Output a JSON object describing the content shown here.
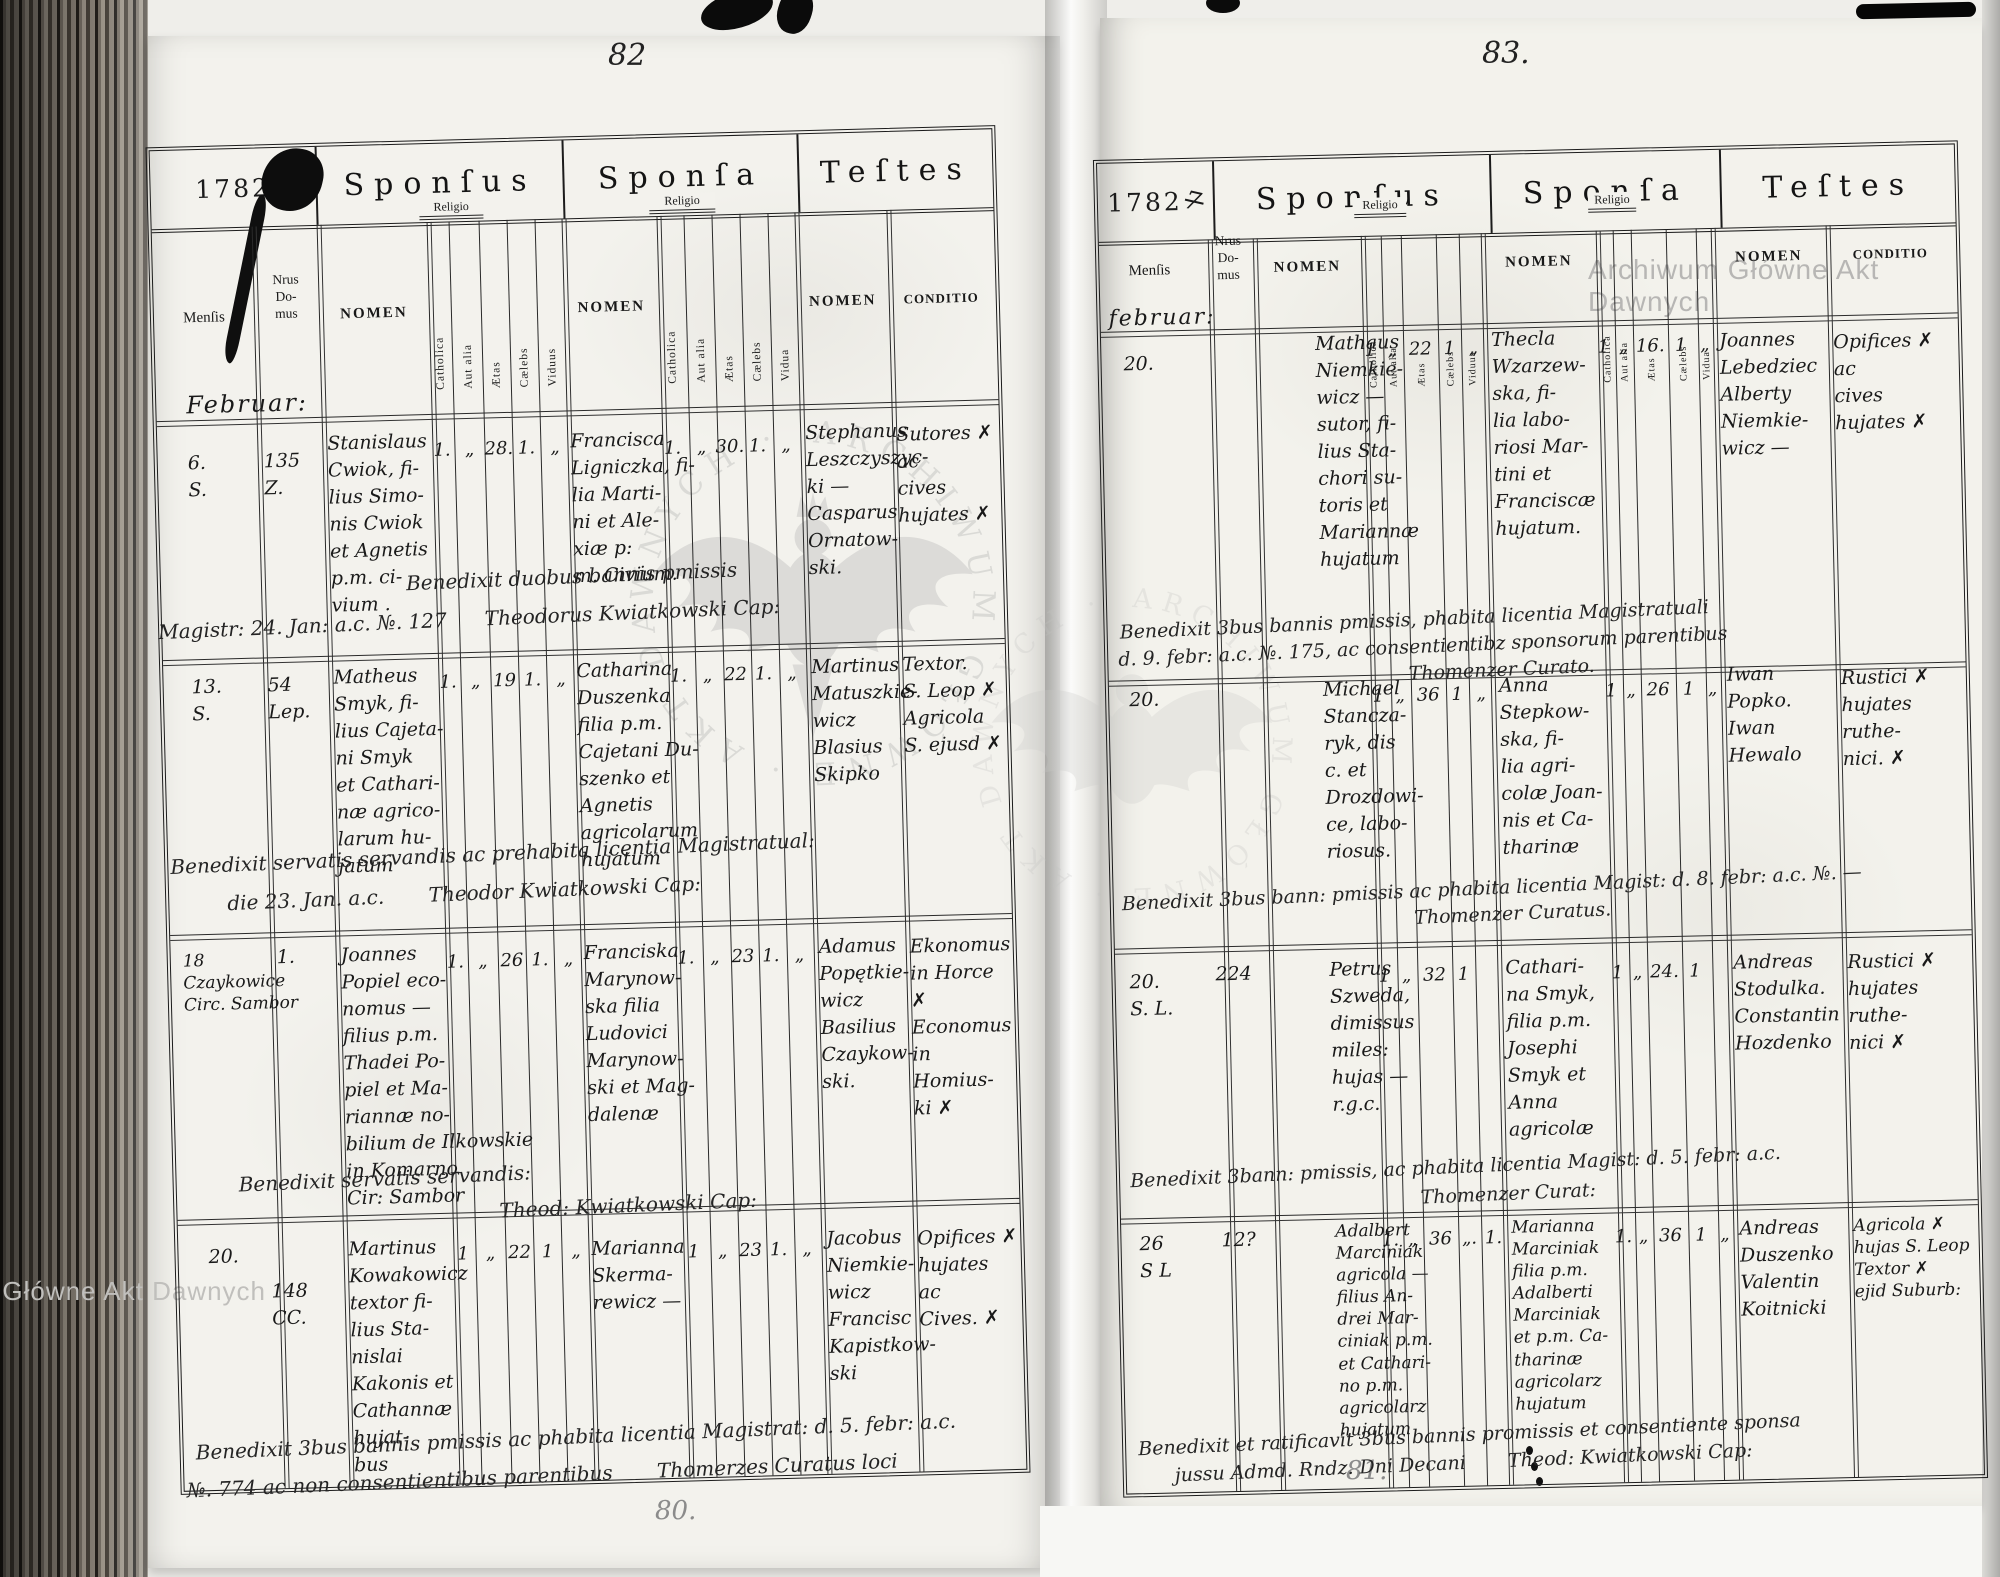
{
  "watermark": {
    "corner_text": "Archiwum Główne Akt Dawnych",
    "circular_text": "ARCHIWUM GŁÓWNE · AKT DAWNYCH ·"
  },
  "sections": {
    "sponsus": "Sponſus",
    "sponsa": "Sponſa",
    "testes": "Teſtes"
  },
  "columns": {
    "mensis": "Menſis",
    "nrus": "Nrus\nDo-\nmus",
    "nomen": "NOMEN",
    "religio": "Religio",
    "catholica": "Catholica",
    "aut_alia": "Aut alia",
    "aetas": "Ætas",
    "caelebs": "Cælebs",
    "viduus": "Viduus",
    "vidua": "Vidua",
    "conditio": "CONDITIO"
  },
  "pages": {
    "left": {
      "page_number": "82",
      "pencil_number": "80.",
      "year": "1782",
      "month_heading": "Februar:",
      "entries": [
        {
          "mensis": "6.\nS.",
          "house": "135\nZ.",
          "sponsus_name": "Stanislaus\nCwiok, fi-\nlius Simo-\nnis Cwiok\net Agnetis\np.m. ci-\nvium .",
          "sponsus_marks": [
            "1.",
            "„",
            "28.",
            "1.",
            "„"
          ],
          "sponsa_name": "Francisca\nLigniczka, fi-\nlia Marti-\nni et Ale-\nxiæ p:\nm. Civium.",
          "sponsa_marks": [
            "1.",
            "„",
            "30.",
            "1.",
            "„"
          ],
          "witnesses": "Stephanus\nLeszczyszyc-\nki —\nCasparus\nOrnatow-\nski.",
          "conditio": "Sutores ✗\nac\ncives\nhujates ✗",
          "note1": "Benedixit duobus bannis pmissis",
          "note2": "Magistr: 24. Jan: a.c. №. 127      Theodorus Kwiatkowski Cap:"
        },
        {
          "mensis": "13.\nS.",
          "house": "54\nLep.",
          "sponsus_name": "Matheus\nSmyk, fi-\nlius Cajeta-\nni Smyk\net Cathari-\nnæ agrico-\nlarum hu-\njatum",
          "sponsus_marks": [
            "1.",
            "„",
            "19",
            "1.",
            "„"
          ],
          "sponsa_name": "Catharina\nDuszenka\nfilia p.m.\nCajetani Du-\nszenko et\nAgnetis\nagricolarum\nhujatum",
          "sponsa_marks": [
            "1.",
            "„",
            "22",
            "1.",
            "„"
          ],
          "witnesses": "Martinus\nMatuszkie-\nwicz\nBlasius\nSkipko",
          "conditio": "Textor.\nS. Leop ✗\nAgricola\nS. ejusd ✗",
          "note1": "Benedixit servatis servandis ac prehabita licentia Magistratual:",
          "note2": "die 23. Jan. a.c.       Theodor Kwiatkowski Cap:"
        },
        {
          "mensis": "18\nCzaykowice\nCirc. Sambor",
          "house": "1.",
          "sponsus_name": "Joannes\nPopiel eco-\nnomus —\nfilius p.m.\nThadei Po-\npiel et Ma-\nriannæ no-\nbilium de Ilkowskie\nin Komarno\nCir: Sambor",
          "sponsus_marks": [
            "1.",
            "„",
            "26",
            "1.",
            "„"
          ],
          "sponsa_name": "Franciska\nMarynow-\nska filia\nLudovici\nMarynow-\nski et Mag-\ndalenæ",
          "sponsa_marks": [
            "1.",
            "„",
            "23",
            "1.",
            "„"
          ],
          "witnesses": "Adamus\nPopętkie-\nwicz\nBasilius\nCzaykow-\nski.",
          "conditio": "Ekonomus\nin Horce ✗\nEconomus\nin Homius-\nki ✗",
          "note1": "Benedixit servatis servandis:",
          "note2": "Theod: Kwiatkowski Cap:"
        },
        {
          "mensis": "20.",
          "house": "148\nCC.",
          "sponsus_name": "Martinus\nKowakowicz\ntextor fi-\nlius Sta-\nnislai\nKakonis et\nCathannæ\nhujat-\nbus",
          "sponsus_marks": [
            "1",
            "„",
            "22",
            "1",
            "„"
          ],
          "sponsa_name": "Marianna\nSkerma-\nrewicz —",
          "sponsa_marks": [
            "1",
            "„",
            "23",
            "1.",
            "„"
          ],
          "witnesses": "Jacobus\nNiemkie-\nwicz\nFrancisc\nKapistkow-\nski",
          "conditio": "Opifices ✗\nhujates\nac\nCives. ✗",
          "note1": "Benedixit 3bus bannis pmissis ac phabita licentia Magistrat: d. 5. febr: a.c.",
          "note2": "№. 774 ac non consentientibus parentibus       Thomerzes Curatus loci"
        }
      ]
    },
    "right": {
      "page_number": "83.",
      "pencil_number": "81.",
      "year": "1782",
      "year_mark": "7",
      "month_heading": "februar:",
      "entries": [
        {
          "mensis": "20.",
          "house": "",
          "sponsus_name": "Mathaus\nNiemkie-\nwicz —\nsutor, fi-\nlius Sta-\nchori su-\ntoris et\nMariannæ\nhujatum",
          "sponsus_marks": [
            "1",
            "„",
            "22",
            "1",
            "„"
          ],
          "sponsa_name": "Thecla\nWzarzew-\nska, fi-\nlia labo-\nriosi Mar-\ntini et\nFranciscæ\nhujatum.",
          "sponsa_marks": [
            "1",
            "„",
            "16.",
            "1",
            "„"
          ],
          "witnesses": "Joannes\nLebedziec\nAlberty\nNiemkie-\nwicz —",
          "conditio": "Opifices ✗\nac\ncives\nhujates ✗",
          "note1": "Benedixit 3bus bannis pmissis, phabita licentia Magistratuali",
          "note2": "d. 9. febr: a.c. №. 175, ac consentientibz sponsorum parentibus",
          "note3": "Thomenzer Curato."
        },
        {
          "mensis": "20.",
          "house": "",
          "sponsus_name": "Michael\nStancza-\nryk, dis\nc. et\nDrozdowi-\nce, labo-\nriosus.",
          "sponsus_marks": [
            "1",
            "„",
            "36",
            "1",
            "„"
          ],
          "sponsa_name": "Anna\nStepkow-\nska, fi-\nlia agri-\ncolæ Joan-\nnis et Ca-\ntharinæ",
          "sponsa_marks": [
            "1",
            "„",
            "26",
            "1",
            "„"
          ],
          "witnesses": "Iwan\nPopko.\nIwan\nHewalo",
          "conditio": "Rustici ✗\nhujates\nruthe-\nnici. ✗",
          "note1": "Benedixit 3bus bann: pmissis ac phabita licentia Magist: d. 8. febr: a.c. №. —",
          "note2": "Thomenzer Curatus."
        },
        {
          "mensis": "20.\nS. L.",
          "house": "224",
          "sponsus_name": "Petrus\nSzweda,\ndimissus\nmiles:\nhujas —\nr.g.c.",
          "sponsus_marks": [
            "1",
            "„",
            "32",
            "1",
            ""
          ],
          "sponsa_name": "Cathari-\nna Smyk,\nfilia p.m.\nJosephi\nSmyk et\nAnna\nagricolæ",
          "sponsa_marks": [
            "1",
            "„",
            "24.",
            "1",
            ""
          ],
          "witnesses": "Andreas\nStodulka.\nConstantin\nHozdenko",
          "conditio": "Rustici ✗\nhujates\nruthe-\nnici ✗",
          "note1": "Benedixit 3bann: pmissis, ac phabita licentia Magist: d. 5. febr: a.c.",
          "note2": "Thomenzer Curat:"
        },
        {
          "mensis": "26\nS L",
          "house": "12?",
          "sponsus_name": "Adalbert\nMarciniak\nagricola —\nfilius An-\ndrei Mar-\nciniak p.m.\net Cathari-\nno p.m.\nagricolarz\nhujatum",
          "sponsus_marks": [
            "1.",
            "„",
            "36",
            "„.",
            "1."
          ],
          "sponsa_name": "Marianna\nMarciniak\nfilia p.m.\nAdalberti\nMarciniak\net p.m. Ca-\ntharinæ\nagricolarz\nhujatum",
          "sponsa_marks": [
            "1.",
            "„",
            "36",
            "1",
            "„"
          ],
          "witnesses": "Andreas\nDuszenko\nValentin\nKoitnicki",
          "conditio": "Agricola ✗\nhujas S. Leop\nTextor ✗\nejid Suburb:",
          "note1": "Benedixit et ratificavit 3bus bannis promissis et consentiente sponsa",
          "note2": "jussu Admd. Rndz. Dni Decani       Theod: Kwiatkowski Cap:"
        }
      ]
    }
  }
}
